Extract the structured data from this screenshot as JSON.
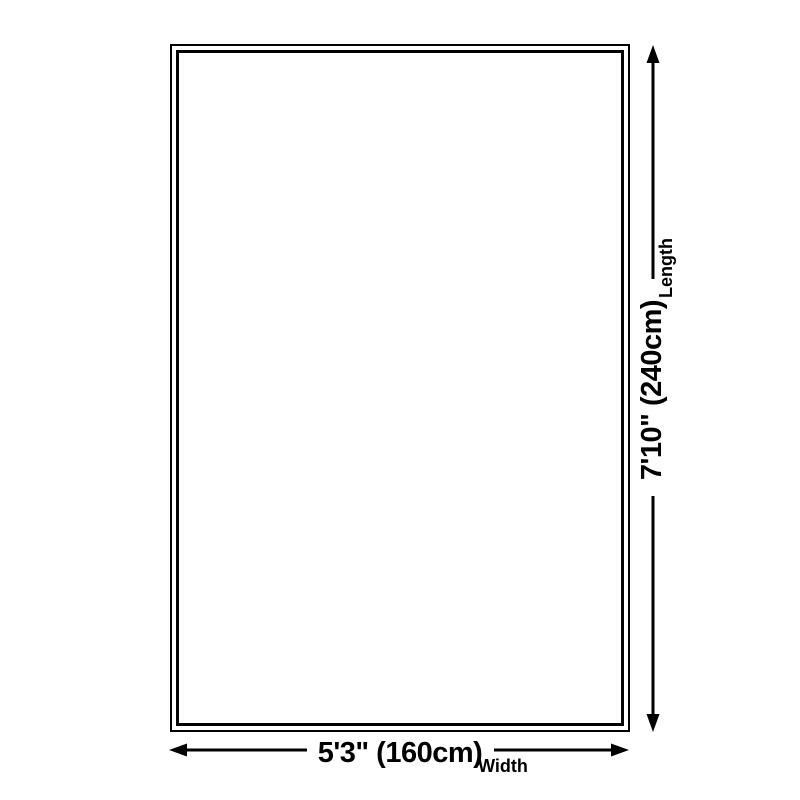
{
  "colors": {
    "ink": "#000000",
    "background": "#ffffff"
  },
  "diagram": {
    "type": "product-size-diagram",
    "subject": "rug outline"
  },
  "dimensions": {
    "length": {
      "label": "Length",
      "value": "7'10\" (240cm)"
    },
    "width": {
      "label": "Width",
      "value": "5'3\" (160cm)"
    }
  }
}
